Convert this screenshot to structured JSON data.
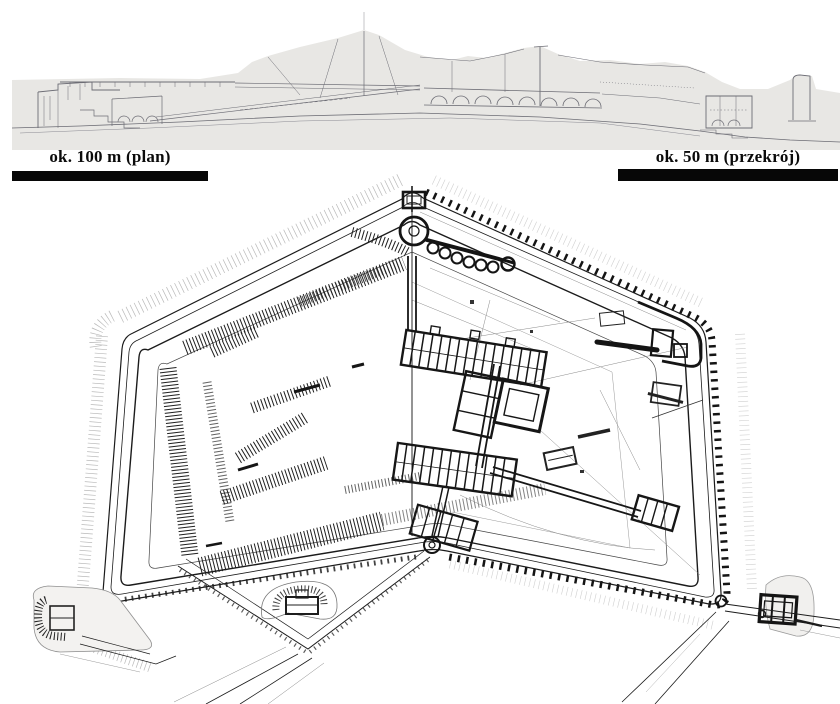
{
  "figure": {
    "type": "fortification-architectural-drawing",
    "scale_bars": {
      "plan": {
        "label": "ok. 100 m (plan)"
      },
      "section": {
        "label": "ok. 50 m (przekrój)"
      }
    },
    "colors": {
      "paper": "#ffffff",
      "section_paper": "#e8e7e4",
      "pencil": "#6d6d75",
      "ink": "#1b1b1b",
      "scalebar": "#070707"
    }
  }
}
